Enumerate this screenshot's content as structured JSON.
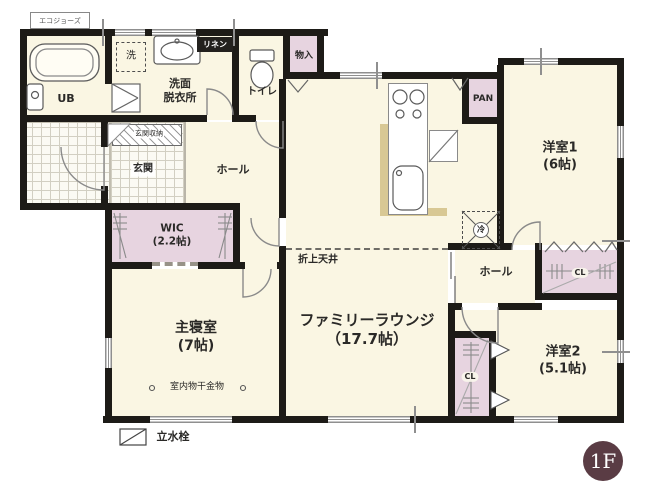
{
  "title": "1F間取り図",
  "floor_badge": "1F",
  "labels": {
    "water_heater": "エコジョーズ",
    "ub": "UB",
    "washer": "洗",
    "linen": "リネン",
    "washroom": "洗面\n脱衣所",
    "toilet": "トイレ",
    "storage": "物入",
    "pantry": "PAN",
    "bedroom1": "洋室1\n(6帖)",
    "closet1": "CL",
    "fridge": "冷",
    "hall_right": "ホール",
    "bedroom2": "洋室2\n(5.1帖)",
    "closet2": "CL",
    "family_lounge": "ファミリーラウンジ\n（17.7帖）",
    "coffered_ceiling": "折上天井",
    "hall_left": "ホール",
    "entrance": "玄関",
    "entrance_storage": "玄関収納",
    "wic": "WIC\n(2.2帖)",
    "master_bedroom": "主寝室\n(7帖)",
    "indoor_drying": "室内物干金物",
    "faucet": "立水栓"
  },
  "colors": {
    "wall": "#1d1b17",
    "floor": "#faf6e3",
    "closet_fill": "#e7d4e0",
    "tile_line": "#d2cfc2",
    "counter_edge": "#d8c894",
    "badge": "#5a3c44",
    "door_arc": "#8a8a8a"
  }
}
